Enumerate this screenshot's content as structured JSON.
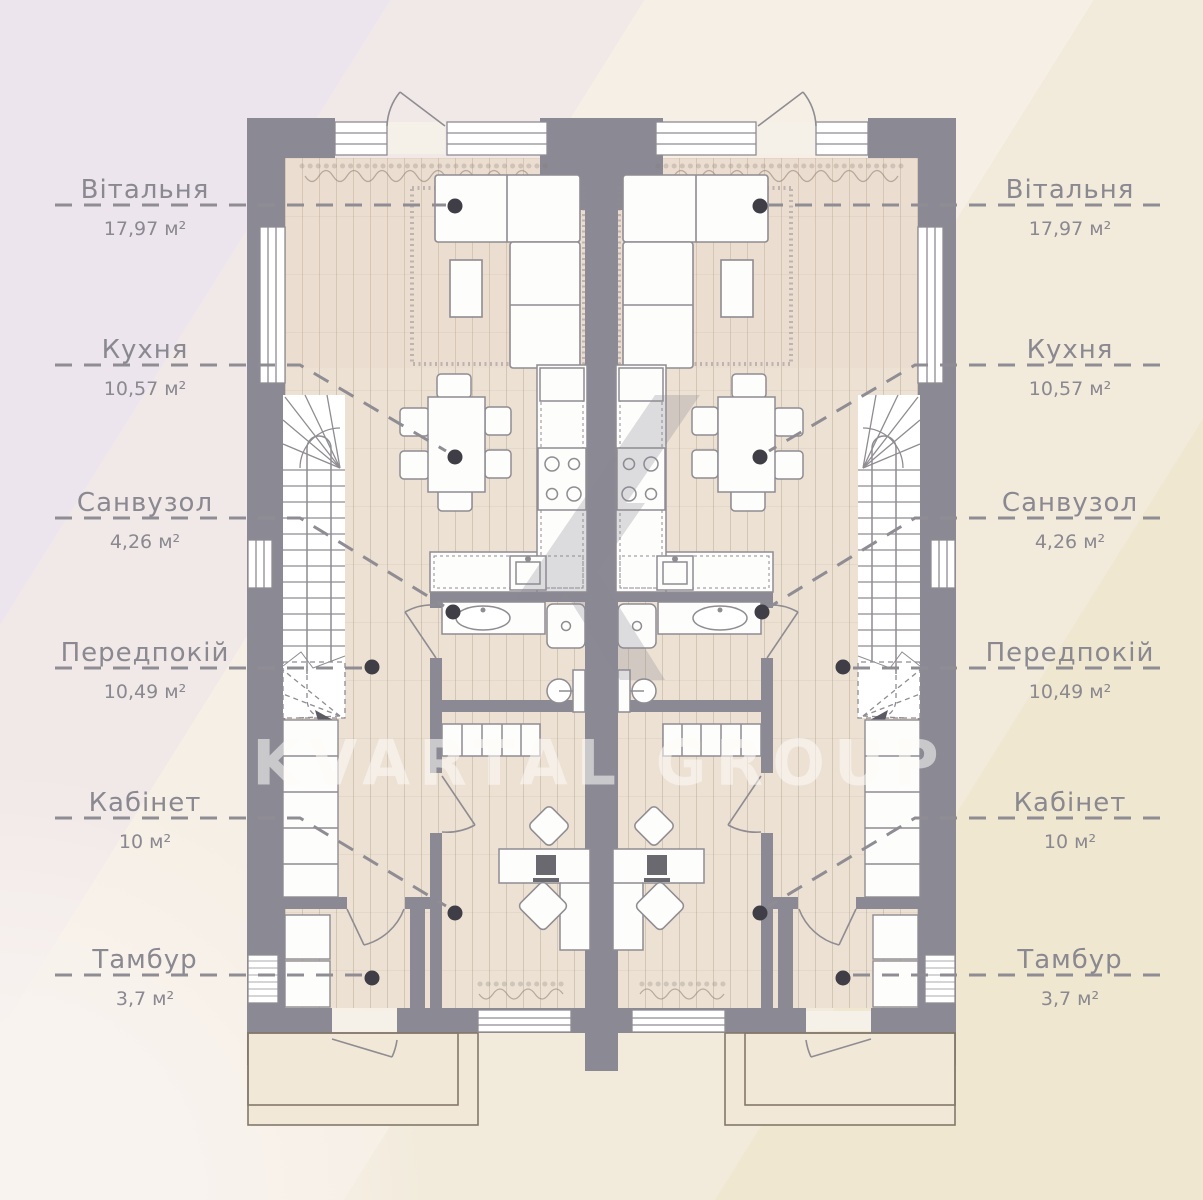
{
  "watermark": {
    "brand": "KVARTAL GROUP"
  },
  "rooms": [
    {
      "name": "Вітальня",
      "area": "17,97 м²"
    },
    {
      "name": "Кухня",
      "area": "10,57 м²"
    },
    {
      "name": "Санвузол",
      "area": "4,26 м²"
    },
    {
      "name": "Передпокій",
      "area": "10,49 м²"
    },
    {
      "name": "Кабінет",
      "area": "10 м²"
    },
    {
      "name": "Тамбур",
      "area": "3,7 м²"
    }
  ],
  "plan": {
    "type": "mirrored-duplex-floor-plan",
    "units": [
      "left",
      "right"
    ],
    "features": [
      "living-room-sofa",
      "dining-table-6-chairs",
      "kitchen-counter-stove-sink",
      "bathroom-vanity-toilet",
      "winder-staircase",
      "hall-wardrobe",
      "office-desk-chairs",
      "vestibule",
      "entrance-porch"
    ]
  },
  "palette": {
    "wall": "#8b8993",
    "floor": "#ece1d3",
    "plank_line": "#cfc3b2",
    "furniture_stroke": "#8f8c92",
    "label_text": "#8a8890",
    "leader_line": "#8f8d93",
    "leader_dot": "#3f3d45",
    "porch_line": "#84786a",
    "background_bands": [
      "#ece5ed",
      "#f1e9e8",
      "#f6efe5",
      "#f2ebdc",
      "#efe7cf"
    ],
    "watermark_text_color": "rgba(253,251,247,0.55)"
  }
}
